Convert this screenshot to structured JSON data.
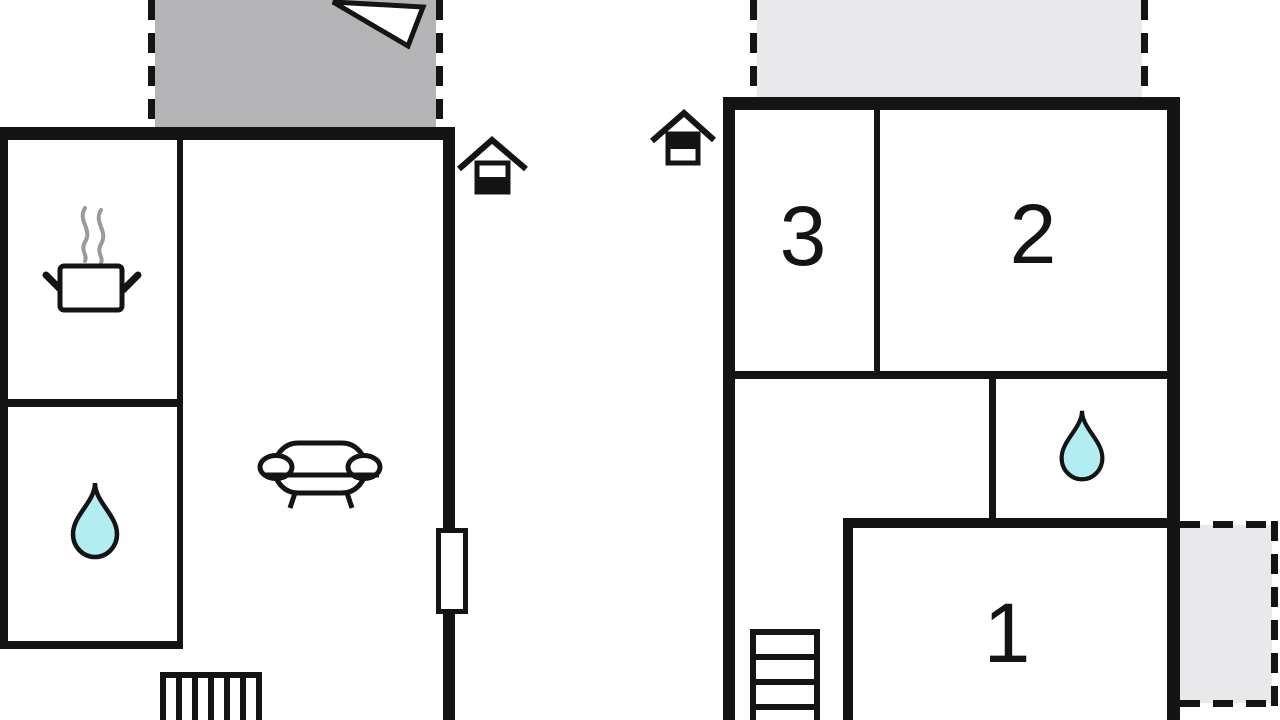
{
  "page": {
    "kind": "floor-plan-drawing",
    "background": "#ffffff"
  },
  "colors": {
    "wall": "#141414",
    "terrace_fill": "#b4b4b6",
    "balcony_fill": "#e9e9eb",
    "water_fill": "#b2edf2",
    "steam": "#9a9a9a",
    "window_fill": "#ffffff",
    "text": "#141414"
  },
  "ground_floor_plan": {
    "level_indicator": "house icon, lower half filled (ground floor)",
    "terrace": {
      "position": "top",
      "edges_dashed": [
        "left",
        "right"
      ],
      "shade": "dark-gray"
    },
    "north_arrow": "white triangle in terrace, pointing upper-left",
    "rooms": {
      "kitchen": {
        "icon": "cooking-pot-icon"
      },
      "bathroom": {
        "icon": "water-drop-icon"
      },
      "living_room": {
        "icon": "sofa-icon",
        "window": "right wall",
        "stairs": "bottom"
      }
    }
  },
  "upper_floor_plan": {
    "level_indicator": "house icon, upper half filled (upper floor)",
    "balconies": [
      {
        "position": "top",
        "edges_dashed": [
          "left",
          "right"
        ],
        "shade": "light-gray"
      },
      {
        "position": "right",
        "edges_dashed": [
          "top",
          "right",
          "bottom"
        ],
        "shade": "light-gray"
      }
    ],
    "rooms": [
      {
        "label": "3"
      },
      {
        "label": "2"
      },
      {
        "label": "1"
      }
    ],
    "bathroom": {
      "icon": "water-drop-icon"
    },
    "stairs": "bottom-left, descending"
  }
}
